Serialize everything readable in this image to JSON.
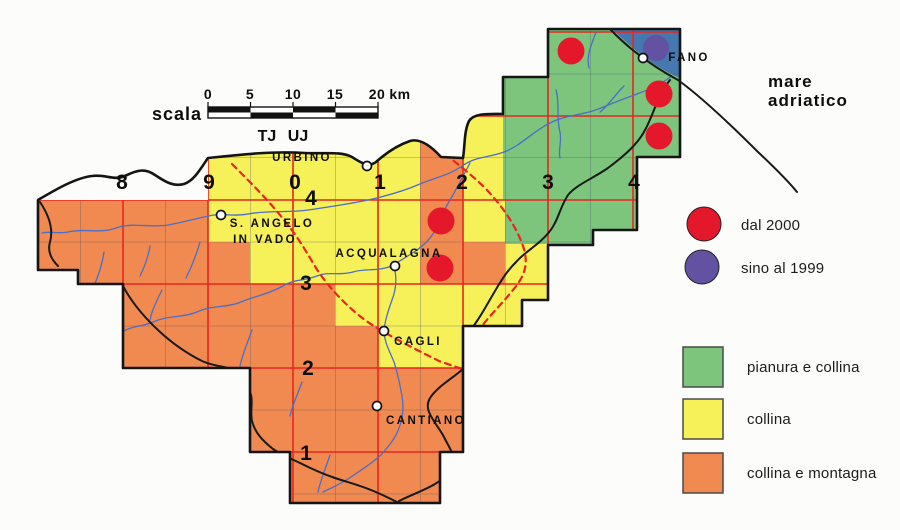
{
  "figure": {
    "scale": {
      "label": "scala",
      "ticks": [
        "0",
        "5",
        "10",
        "15",
        "20"
      ],
      "unit": "km"
    },
    "zones": {
      "left": "TJ",
      "right": "UJ"
    },
    "sea": {
      "line1": "mare",
      "line2": "adriatico"
    },
    "grid": {
      "top": [
        "8",
        "9",
        "0",
        "1",
        "2",
        "3",
        "4"
      ],
      "left": [
        "4",
        "3",
        "2",
        "1"
      ]
    },
    "towns": {
      "urbino": "URBINO",
      "sangelo_line1": "S. ANGELO",
      "sangelo_line2": "IN VADO",
      "acqualagna": "ACQUALAGNA",
      "cagli": "CAGLI",
      "cantiano": "CANTIANO",
      "fano": "FANO"
    },
    "legend_markers": [
      {
        "label": "dal 2000",
        "color": "#e5172b"
      },
      {
        "label": "sino al 1999",
        "color": "#6252a1"
      }
    ],
    "legend_areas": [
      {
        "label": "pianura e collina",
        "color": "#7dc57d"
      },
      {
        "label": "collina",
        "color": "#f6f158"
      },
      {
        "label": "collina e montagna",
        "color": "#f08a50"
      }
    ],
    "colors": {
      "grid_red": "#e8261d",
      "river_blue": "#4b6ec6",
      "sea_blue": "#4478ae",
      "boundary_black": "#151515"
    }
  }
}
